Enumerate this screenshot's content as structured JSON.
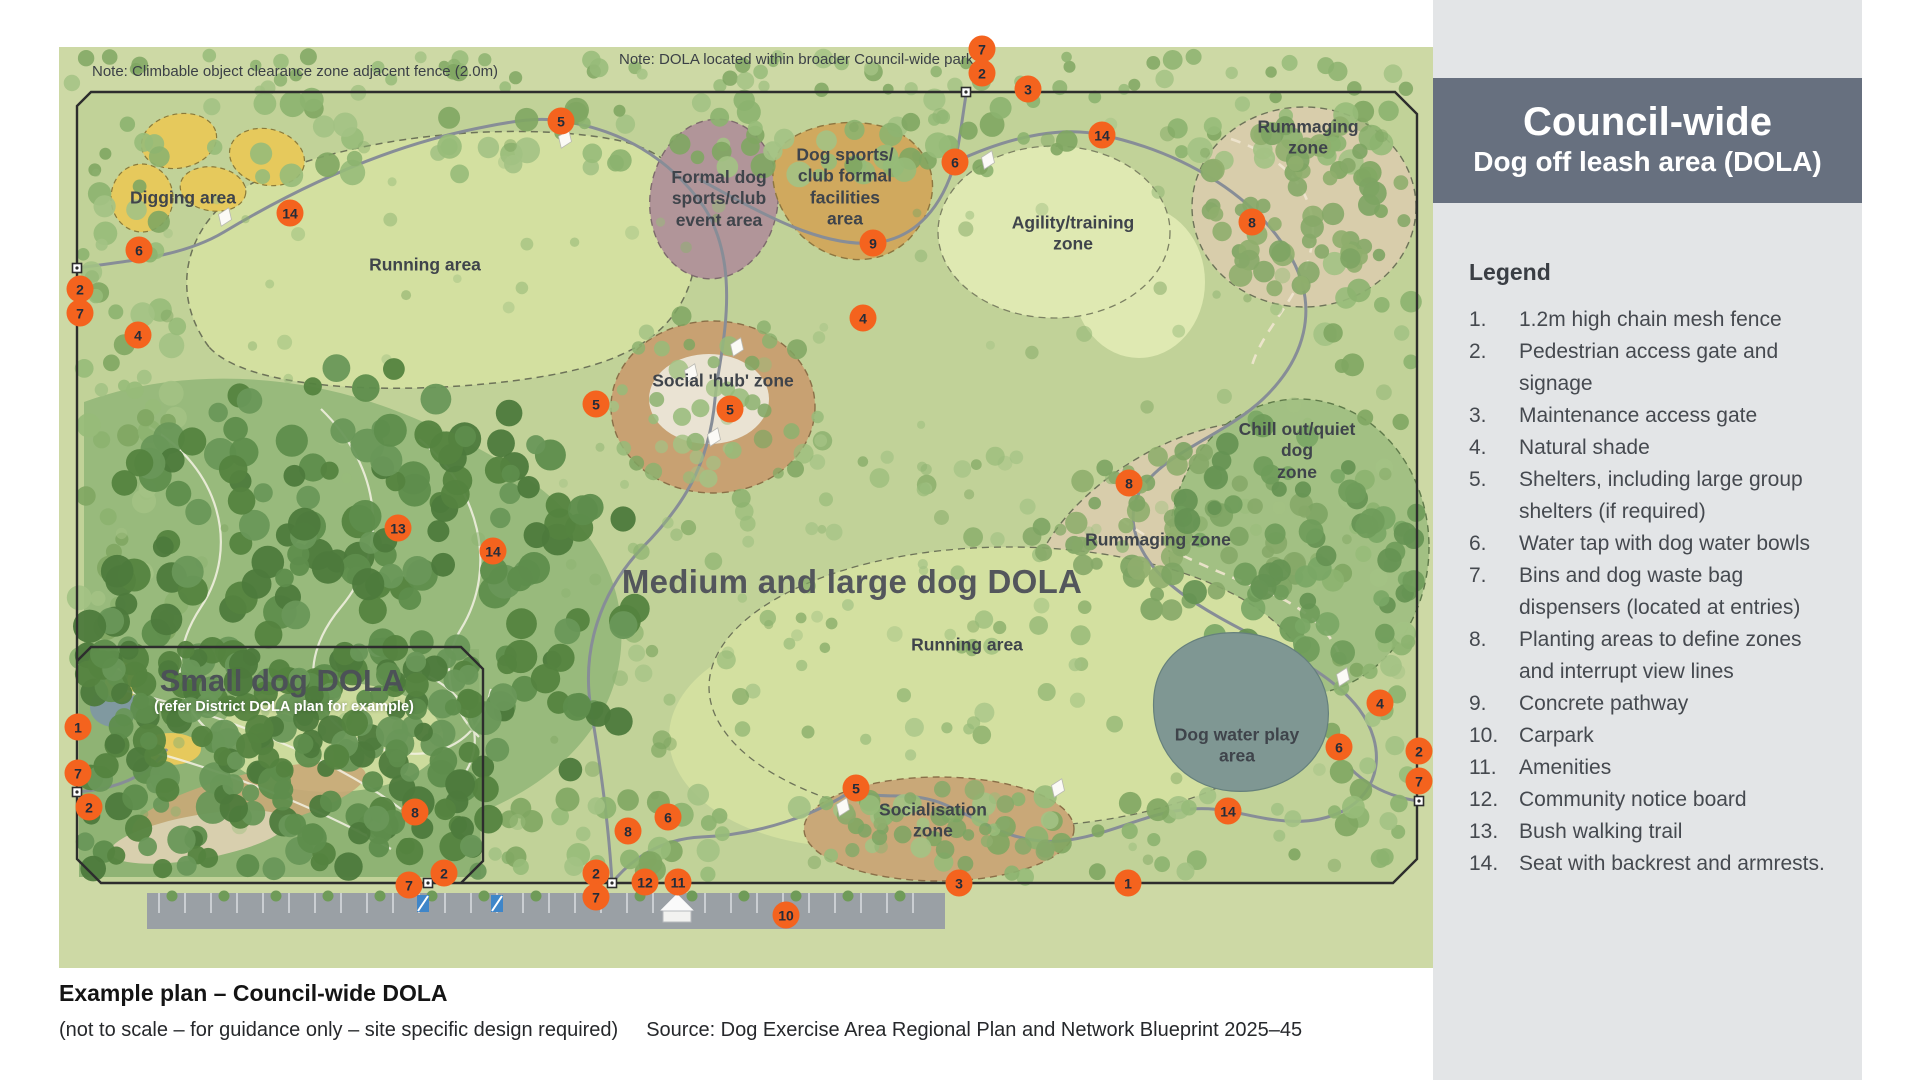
{
  "header": {
    "title": "Council-wide",
    "subtitle": "Dog off leash area (DOLA)"
  },
  "legend": {
    "title": "Legend",
    "items": [
      {
        "n": "1.",
        "label": "1.2m high chain mesh fence"
      },
      {
        "n": "2.",
        "label": "Pedestrian access gate and signage"
      },
      {
        "n": "3.",
        "label": "Maintenance access gate"
      },
      {
        "n": "4.",
        "label": "Natural shade"
      },
      {
        "n": "5.",
        "label": "Shelters, including large group shelters (if required)"
      },
      {
        "n": "6.",
        "label": "Water tap with dog water bowls"
      },
      {
        "n": "7.",
        "label": "Bins and dog waste bag dispensers (located at entries)"
      },
      {
        "n": "8.",
        "label": "Planting areas to define zones and interrupt view lines"
      },
      {
        "n": "9.",
        "label": "Concrete pathway"
      },
      {
        "n": "10.",
        "label": "Carpark"
      },
      {
        "n": "11.",
        "label": "Amenities"
      },
      {
        "n": "12.",
        "label": "Community notice board"
      },
      {
        "n": "13.",
        "label": "Bush walking trail"
      },
      {
        "n": "14.",
        "label": "Seat with backrest and armrests."
      }
    ]
  },
  "map": {
    "notes": {
      "left": "Note: Climbable object clearance zone adjacent fence (2.0m)",
      "top": "Note: DOLA located within broader Council-wide park"
    },
    "zone_labels": [
      {
        "id": "digging-area",
        "text": "Digging area",
        "x": 124,
        "y": 151,
        "cls": ""
      },
      {
        "id": "running-area-top",
        "text": "Running area",
        "x": 366,
        "y": 218,
        "cls": ""
      },
      {
        "id": "formal-event-area",
        "text": "Formal dog\nsports/club\nevent area",
        "x": 660,
        "y": 152,
        "cls": ""
      },
      {
        "id": "club-facilities-area",
        "text": "Dog sports/\nclub formal\nfacilities\narea",
        "x": 786,
        "y": 140,
        "cls": ""
      },
      {
        "id": "agility-zone",
        "text": "Agility/training\nzone",
        "x": 1014,
        "y": 187,
        "cls": ""
      },
      {
        "id": "rummaging-zone-top",
        "text": "Rummaging zone",
        "x": 1249,
        "y": 91,
        "cls": ""
      },
      {
        "id": "social-hub-zone",
        "text": "Social 'hub' zone",
        "x": 664,
        "y": 334,
        "cls": ""
      },
      {
        "id": "chill-out-zone",
        "text": "Chill out/quiet dog\nzone",
        "x": 1238,
        "y": 404,
        "cls": ""
      },
      {
        "id": "rummaging-zone-mid",
        "text": "Rummaging zone",
        "x": 1099,
        "y": 493,
        "cls": ""
      },
      {
        "id": "running-area-bottom",
        "text": "Running area",
        "x": 908,
        "y": 598,
        "cls": ""
      },
      {
        "id": "socialisation-zone",
        "text": "Socialisation\nzone",
        "x": 874,
        "y": 774,
        "cls": ""
      },
      {
        "id": "dog-water-play-area",
        "text": "Dog water play\narea",
        "x": 1178,
        "y": 699,
        "cls": ""
      },
      {
        "id": "medium-large-dola",
        "text": "Medium and large dog DOLA",
        "x": 793,
        "y": 535,
        "cls": "xl"
      },
      {
        "id": "small-dog-dola",
        "text": "Small dog DOLA",
        "x": 223,
        "y": 634,
        "cls": "lg"
      },
      {
        "id": "small-dog-dola-sub",
        "text": "(refer District DOLA plan for example)",
        "x": 225,
        "y": 661,
        "cls": "sub"
      }
    ],
    "markers": [
      {
        "n": "7",
        "x": 923,
        "y": 2
      },
      {
        "n": "2",
        "x": 923,
        "y": 26
      },
      {
        "n": "3",
        "x": 969,
        "y": 42
      },
      {
        "n": "5",
        "x": 502,
        "y": 74
      },
      {
        "n": "14",
        "x": 1043,
        "y": 88
      },
      {
        "n": "6",
        "x": 896,
        "y": 115
      },
      {
        "n": "14",
        "x": 231,
        "y": 166
      },
      {
        "n": "8",
        "x": 1193,
        "y": 175
      },
      {
        "n": "9",
        "x": 814,
        "y": 196
      },
      {
        "n": "6",
        "x": 80,
        "y": 203
      },
      {
        "n": "2",
        "x": 21,
        "y": 242
      },
      {
        "n": "7",
        "x": 21,
        "y": 266
      },
      {
        "n": "4",
        "x": 804,
        "y": 271
      },
      {
        "n": "4",
        "x": 79,
        "y": 288
      },
      {
        "n": "5",
        "x": 537,
        "y": 357
      },
      {
        "n": "5",
        "x": 671,
        "y": 362
      },
      {
        "n": "8",
        "x": 1070,
        "y": 436
      },
      {
        "n": "13",
        "x": 339,
        "y": 481
      },
      {
        "n": "14",
        "x": 434,
        "y": 504
      },
      {
        "n": "4",
        "x": 1321,
        "y": 656
      },
      {
        "n": "1",
        "x": 19,
        "y": 680
      },
      {
        "n": "6",
        "x": 1280,
        "y": 700
      },
      {
        "n": "2",
        "x": 1360,
        "y": 704
      },
      {
        "n": "7",
        "x": 19,
        "y": 726
      },
      {
        "n": "7",
        "x": 1360,
        "y": 734
      },
      {
        "n": "2",
        "x": 30,
        "y": 760
      },
      {
        "n": "14",
        "x": 1169,
        "y": 764
      },
      {
        "n": "8",
        "x": 356,
        "y": 765
      },
      {
        "n": "5",
        "x": 797,
        "y": 741
      },
      {
        "n": "6",
        "x": 609,
        "y": 770
      },
      {
        "n": "8",
        "x": 569,
        "y": 784
      },
      {
        "n": "2",
        "x": 537,
        "y": 826
      },
      {
        "n": "2",
        "x": 385,
        "y": 826
      },
      {
        "n": "12",
        "x": 586,
        "y": 835
      },
      {
        "n": "11",
        "x": 619,
        "y": 835
      },
      {
        "n": "1",
        "x": 1069,
        "y": 836
      },
      {
        "n": "3",
        "x": 900,
        "y": 836
      },
      {
        "n": "7",
        "x": 350,
        "y": 838
      },
      {
        "n": "7",
        "x": 537,
        "y": 850
      },
      {
        "n": "10",
        "x": 727,
        "y": 868
      }
    ]
  },
  "caption": {
    "title": "Example plan – Council-wide DOLA",
    "note": "(not to scale – for guidance only – site specific design required)",
    "source": "Source: Dog Exercise Area Regional Plan and Network Blueprint 2025–45"
  },
  "colors": {
    "accent": "#f4631e",
    "header_bg": "#67707f",
    "sidebar_bg": "#e3e5e7"
  }
}
